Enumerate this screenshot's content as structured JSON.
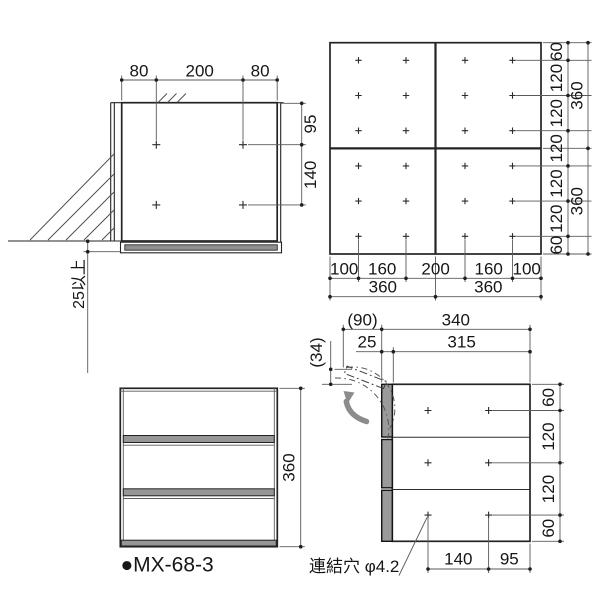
{
  "views": {
    "plan": {
      "dims_top": [
        "80",
        "200",
        "80"
      ],
      "dims_right": [
        "95",
        "140"
      ],
      "clearance_note": "25以上"
    },
    "rear": {
      "dims_col_spacing": [
        "100",
        "160",
        "200",
        "160",
        "100"
      ],
      "dims_width_total": [
        "360",
        "360"
      ],
      "dims_row_spacing": [
        "60",
        "120",
        "120",
        "120",
        "120",
        "120",
        "60"
      ],
      "dims_height_total": [
        "360",
        "360"
      ]
    },
    "front": {
      "dim_height": "360",
      "product_label": "●MX-68-3"
    },
    "side": {
      "dim_open_depth": "(90)",
      "dim_total_depth": "340",
      "dim_door_thickness": "25",
      "dim_body_depth": "315",
      "dim_open_height": "(34)",
      "dims_right": [
        "60",
        "120",
        "120",
        "60"
      ],
      "dims_bottom": [
        "140",
        "95"
      ],
      "connect_hole_note": "連結穴 φ4.2"
    }
  },
  "colors": {
    "line": "#242424",
    "dimension_line": "#5a5a5a",
    "panel_gray": "#9a9a9a",
    "arrow_gray": "#8c8c8c",
    "background": "#ffffff"
  }
}
